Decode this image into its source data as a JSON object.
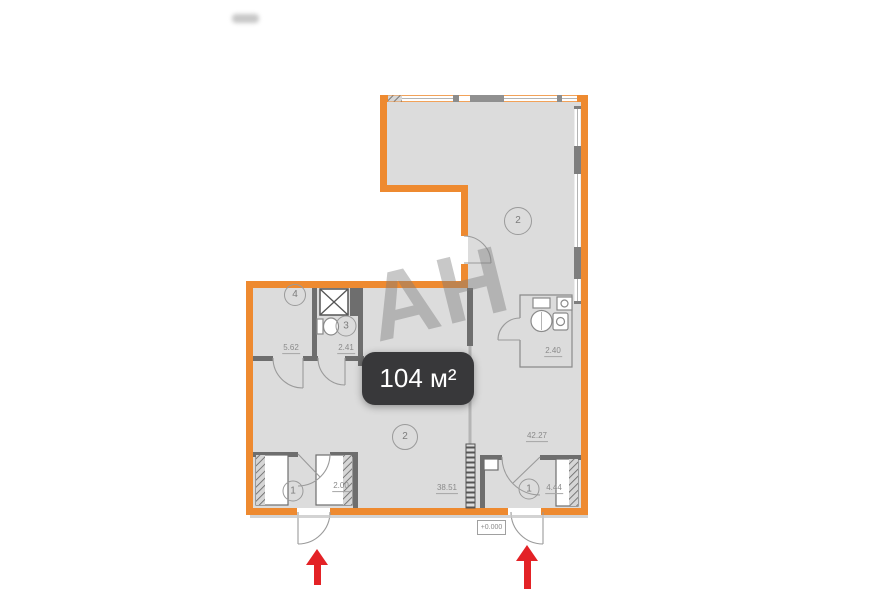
{
  "watermark": {
    "text": "АН"
  },
  "area_badge": {
    "label": "104 м²"
  },
  "level_marker": {
    "label": "+0.000"
  },
  "rooms": [
    {
      "name": "living-room-upper",
      "number": "2",
      "area": "42.27"
    },
    {
      "name": "storage-room",
      "number": "4",
      "area": "5.62"
    },
    {
      "name": "wc",
      "number": "3",
      "area": "2.41"
    },
    {
      "name": "bathroom",
      "area": "2.40"
    },
    {
      "name": "living-room-lower",
      "number": "2",
      "area": "38.51"
    },
    {
      "name": "entry-left",
      "number": "1",
      "area": "2.00"
    },
    {
      "name": "entry-right",
      "number": "1",
      "area": "4.44"
    }
  ],
  "plan_symbols": [
    "vent-shaft",
    "toilet",
    "sink",
    "washing-machine",
    "wardrobe",
    "door-swing",
    "window",
    "entrance-arrow"
  ],
  "colors": {
    "wall_orange": "#EE8A30",
    "floor_gray": "#DCDCDC",
    "partition_gray": "#6E6E6E",
    "fixture_line": "#8A8A8A",
    "dim_text": "#8A8A8A",
    "badge_bg": "#38383A",
    "badge_text": "#FFFFFF",
    "arrow_red": "#E32226",
    "watermark_gray": "#7D7D7D"
  }
}
